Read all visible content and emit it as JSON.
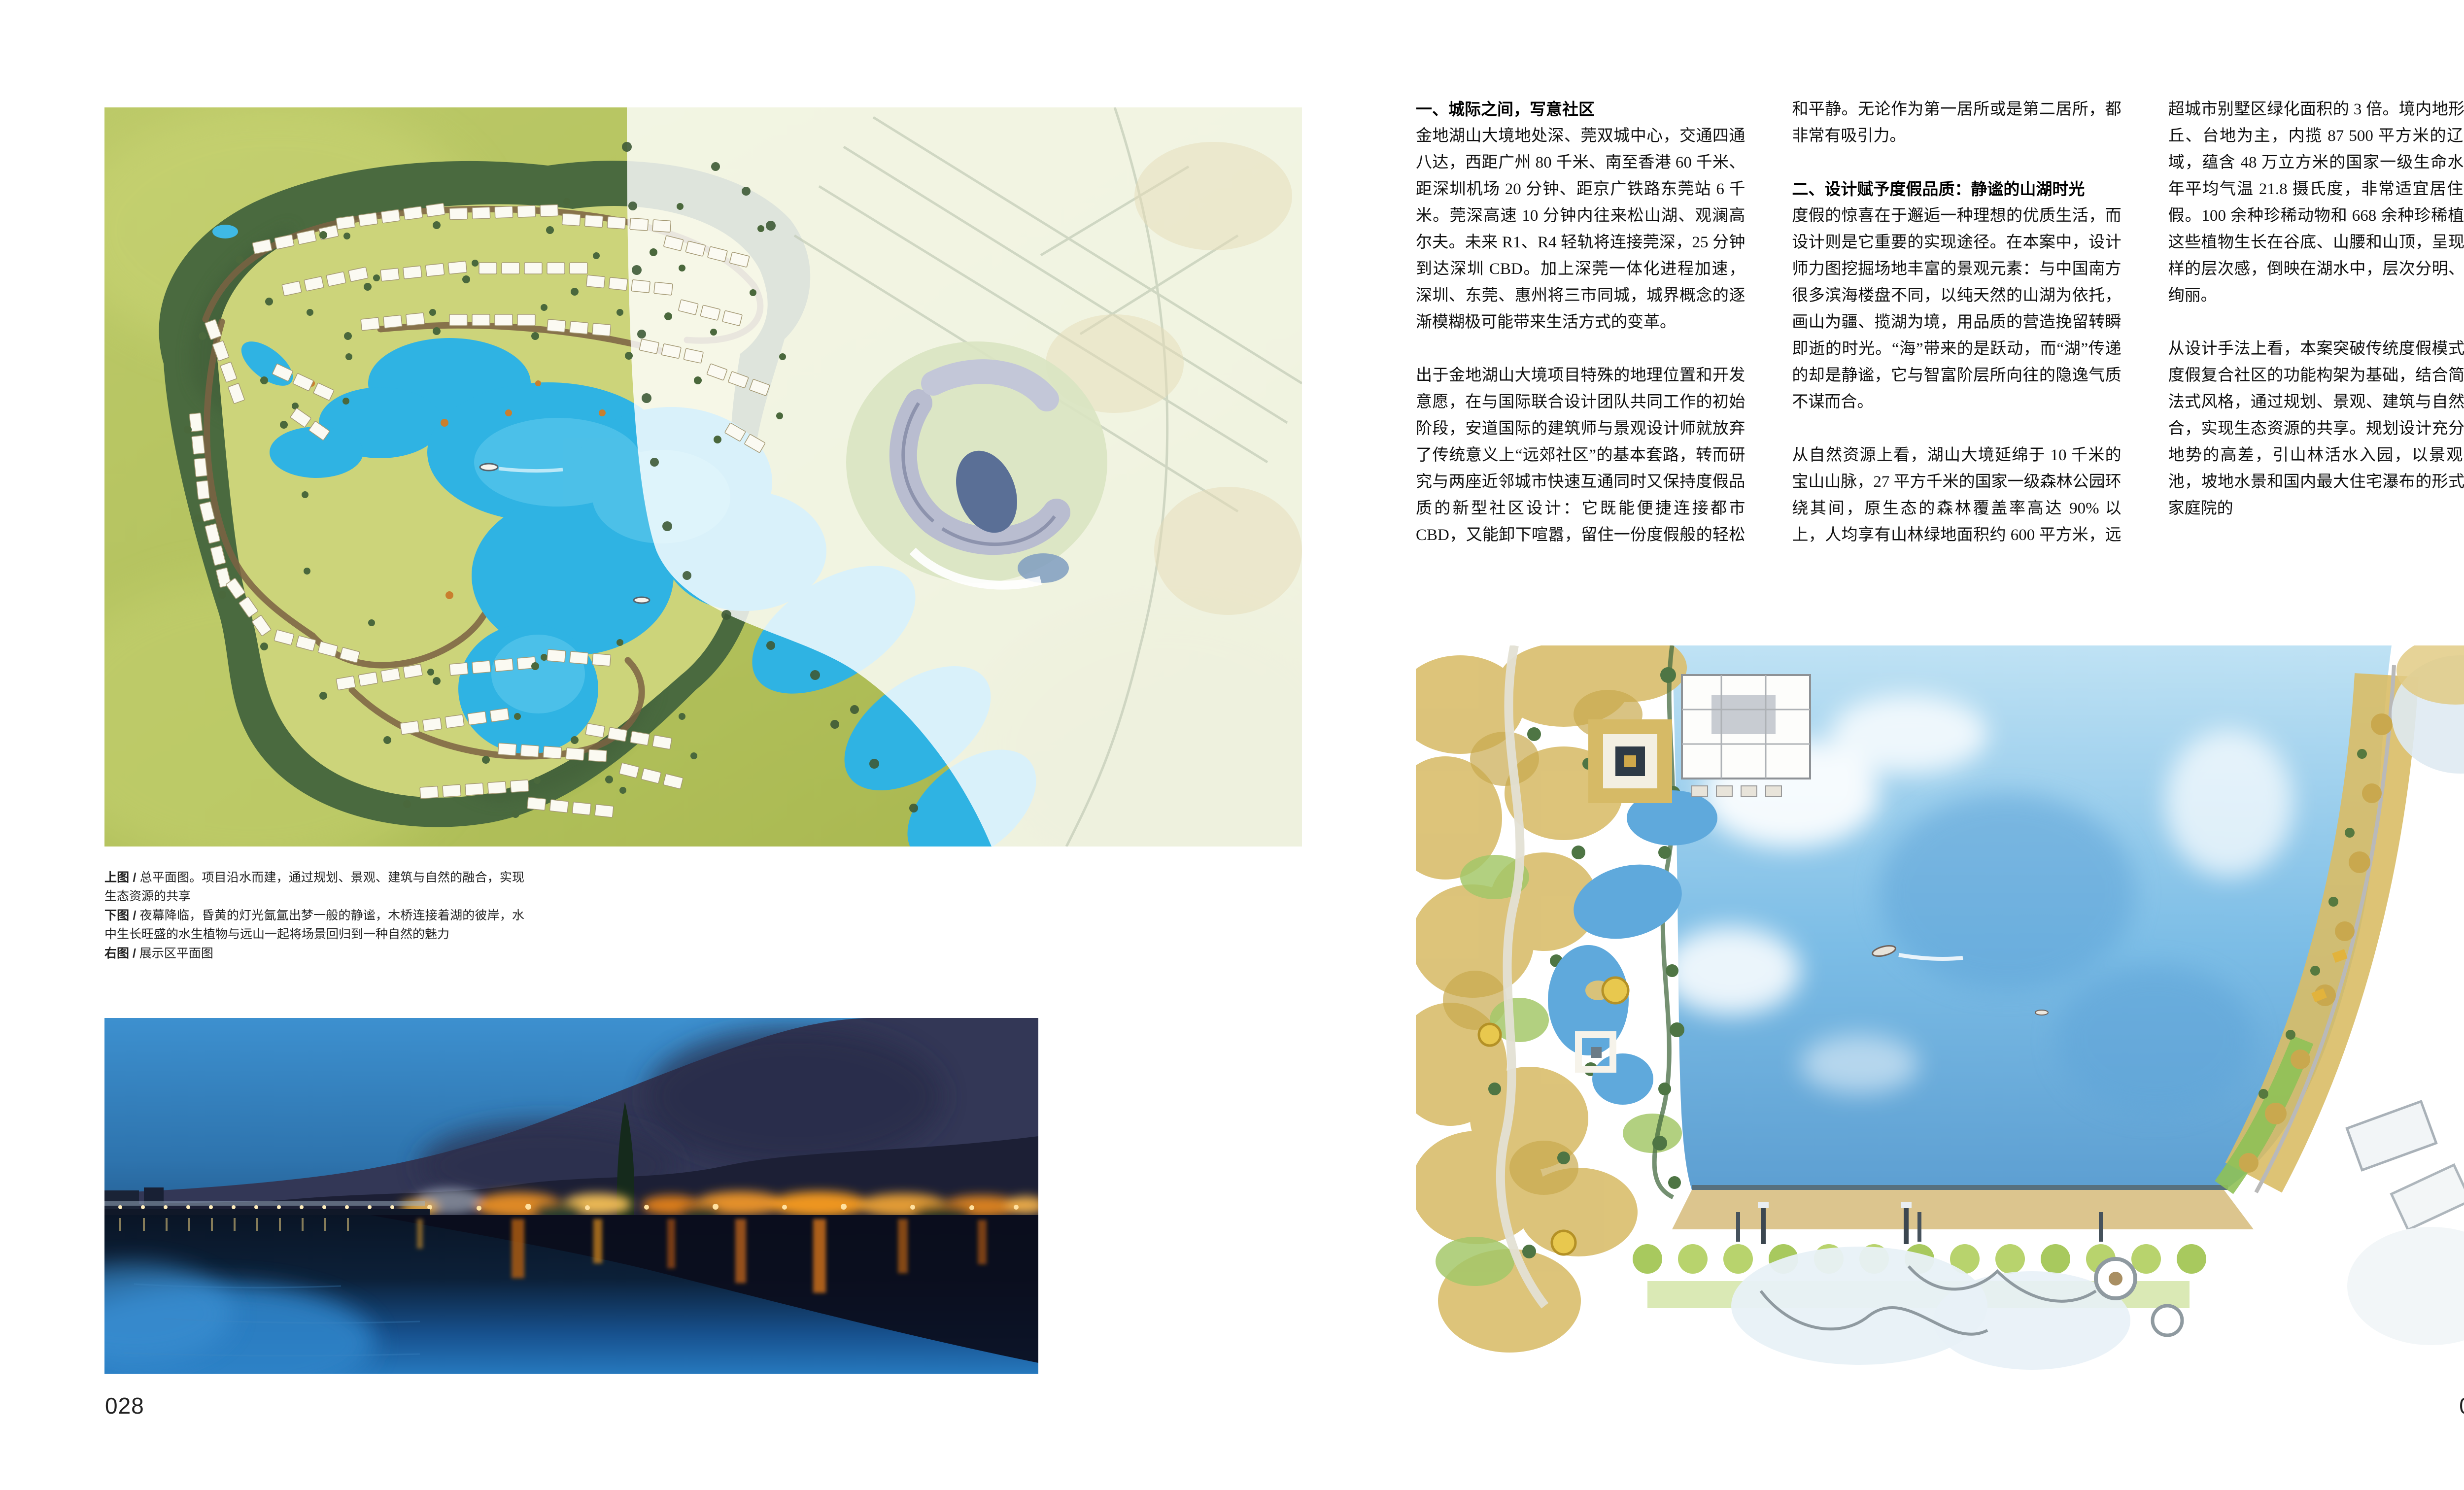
{
  "left_page": {
    "captions": [
      {
        "label": "上图 / ",
        "text": "总平面图。项目沿水而建，通过规划、景观、建筑与自然的融合，实现生态资源的共享"
      },
      {
        "label": "下图 / ",
        "text": "夜幕降临，昏黄的灯光氤氲出梦一般的静谧，木桥连接着湖的彼岸，水中生长旺盛的水生植物与远山一起将场景回归到一种自然的魅力"
      },
      {
        "label": "右图 / ",
        "text": "展示区平面图"
      }
    ],
    "page_number": "028"
  },
  "right_page": {
    "page_number": "029",
    "sections": [
      {
        "heading": "一、城际之间，写意社区",
        "paragraphs": [
          "金地湖山大境地处深、莞双城中心，交通四通八达，西距广州 80 千米、南至香港 60 千米、距深圳机场 20 分钟、距京广铁路东莞站 6 千米。莞深高速 10 分钟内往来松山湖、观澜高尔夫。未来 R1、R4 轻轨将连接莞深，25 分钟到达深圳 CBD。加上深莞一体化进程加速，深圳、东莞、惠州将三市同城，城界概念的逐渐模糊极可能带来生活方式的变革。",
          "出于金地湖山大境项目特殊的地理位置和开发意愿，在与国际联合设计团队共同工作的初始阶段，安道国际的建筑师与景观设计师就放弃了传统意义上“远郊社区”的基本套路，转而研究与两座近邻城市快速互通同时又保持度假品质的新型社区设计：它既能便捷连接都市 CBD，又能卸下喧嚣，留住一份度假般的轻松和平静。无论作为第一居所或是第二居所，都非常有吸引力。"
        ]
      },
      {
        "heading": "二、设计赋予度假品质：静谧的山湖时光",
        "paragraphs": [
          "度假的惊喜在于邂逅一种理想的优质生活，而设计则是它重要的实现途径。在本案中，设计师力图挖掘场地丰富的景观元素：与中国南方很多滨海楼盘不同，以纯天然的山湖为依托，画山为疆、揽湖为境，用品质的营造挽留转瞬即逝的时光。“海”带来的是跃动，而“湖”传递的却是静谧，它与智富阶层所向往的隐逸气质不谋而合。",
          "从自然资源上看，湖山大境延绵于 10 千米的宝山山脉，27 平方千米的国家一级森林公园环绕其间，原生态的森林覆盖率高达 90% 以上，人均享有山林绿地面积约 600 平方米，远超城市别墅区绿化面积的 3 倍。境内地形以低丘、台地为主，内揽 87 500 平方米的辽阔湖域，蕴含 48 万立方米的国家一级生命水源，年平均气温 21.8 摄氏度，非常适宜居住和度假。100 余种珍稀动物和 668 余种珍稀植物，这些植物生长在谷底、山腰和山顶，呈现出多样的层次感，倒映在湖水中，层次分明、异常绚丽。",
          "从设计手法上看，本案突破传统度假模式，以度假复合社区的功能构架为基础，结合简约的法式风格，通过规划、景观、建筑与自然的融合，实现生态资源的共享。规划设计充分利用地势的高差，引山林活水入园，以景观游泳池，坡地水景和国内最大住宅瀑布的形式将私家庭院的"
        ]
      }
    ]
  }
}
